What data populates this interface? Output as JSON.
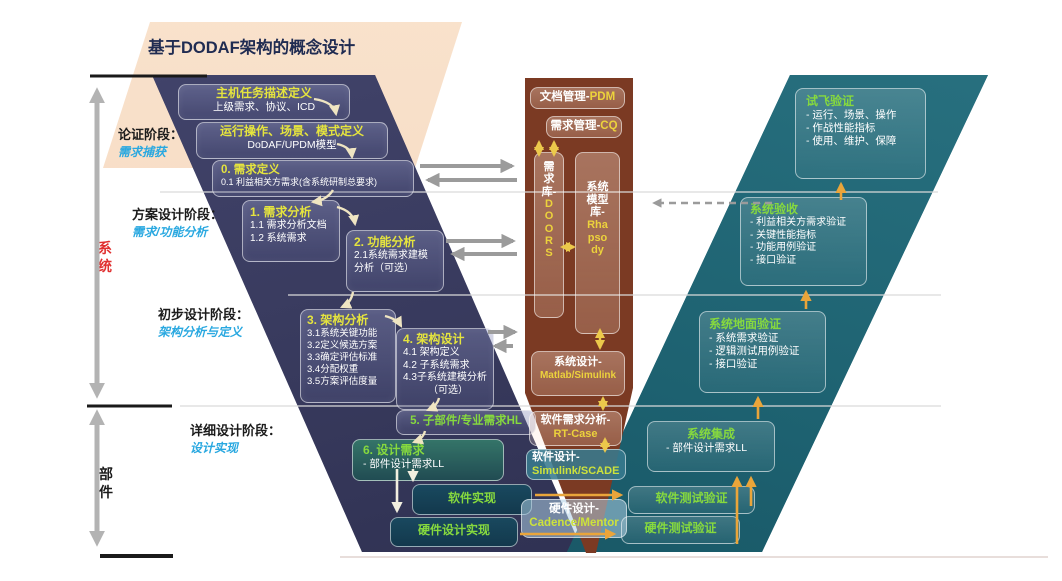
{
  "header": {
    "title": "基于DODAF架构的概念设计"
  },
  "left_rail": {
    "system_label": "系统",
    "component_label": "部件",
    "stages": [
      {
        "name": "论证阶段：",
        "sub": "需求捕获"
      },
      {
        "name": "方案设计阶段：",
        "sub": "需求/功能分析"
      },
      {
        "name": "初步设计阶段：",
        "sub": "架构分析与定义"
      },
      {
        "name": "详细设计阶段：",
        "sub": "设计实现"
      }
    ]
  },
  "design_flow": {
    "boxes": [
      {
        "title": "主机任务描述定义",
        "line1": "上级需求、协议、ICD"
      },
      {
        "title": "运行操作、场景、模式定义",
        "line1": "DoDAF/UPDM模型"
      },
      {
        "title": "0. 需求定义",
        "line1": "0.1 利益相关方需求(含系统研制总要求)"
      },
      {
        "title": "1. 需求分析",
        "line1": "1.1 需求分析文档",
        "line2": "1.2 系统需求"
      },
      {
        "title": "2. 功能分析",
        "line1": "2.1系统需求建模",
        "line2": "分析（可选）"
      },
      {
        "title": "3. 架构分析",
        "line1": "3.1系统关键功能",
        "line2": "3.2定义候选方案",
        "line3": "3.3确定评估标准",
        "line4": "3.4分配权重",
        "line5": "3.5方案评估度量"
      },
      {
        "title": "4. 架构设计",
        "line1": "4.1 架构定义",
        "line2": "4.2 子系统需求",
        "line3": "4.3子系统建模分析",
        "line4": "（可选）"
      },
      {
        "title": "5. 子部件/专业需求HL"
      },
      {
        "title": "6. 设计需求",
        "line1": "- 部件设计需求LL"
      },
      {
        "title": "软件实现"
      },
      {
        "title": "硬件设计实现"
      }
    ]
  },
  "tools_column": {
    "doc_mgmt": {
      "text": "文档管理-",
      "accent": "PDM"
    },
    "req_mgmt": {
      "text": "需求管理-",
      "accent": "CQ"
    },
    "req_db": {
      "text": "需求库-",
      "accent": "DOORS"
    },
    "model_db": {
      "text": "系统模型库-",
      "accent": "Rhapsody"
    },
    "sys_design": {
      "text": "系统设计-",
      "accent": "Matlab/Simulink"
    },
    "sw_req": {
      "text": "软件需求分析-",
      "accent": "RT-Case"
    },
    "sw_design": {
      "text": "软件设计-",
      "accent": "Simulink/SCADE"
    },
    "hw_design": {
      "text": "硬件设计-",
      "accent": "Cadence/Mentor"
    }
  },
  "verify_flow": {
    "boxes": [
      {
        "title": "试飞验证",
        "line1": "- 运行、场景、操作",
        "line2": "- 作战性能指标",
        "line3": "- 使用、维护、保障"
      },
      {
        "title": "系统验收",
        "line1": "- 利益相关方需求验证",
        "line2": "- 关键性能指标",
        "line3": "- 功能用例验证",
        "line4": "- 接口验证"
      },
      {
        "title": "系统地面验证",
        "line1": "- 系统需求验证",
        "line2": "- 逻辑测试用例验证",
        "line3": "- 接口验证"
      },
      {
        "title": "系统集成",
        "line1": "- 部件设计需求LL"
      },
      {
        "title": "软件测试验证"
      },
      {
        "title": "硬件测试验证"
      }
    ]
  },
  "colors": {
    "peach": "#f7dcc3",
    "navy": "#383a5e",
    "teal": "#1f6372",
    "brown": "#7b3a23",
    "title_yellow": "#e5e43e",
    "green": "#86d93e",
    "accent_yellow": "#ecd23c",
    "arrow_yellow": "#eaa53a",
    "arrow_gray": "#9b9b9b",
    "stage_blue": "#29a8e0",
    "system_red": "#e03030"
  }
}
